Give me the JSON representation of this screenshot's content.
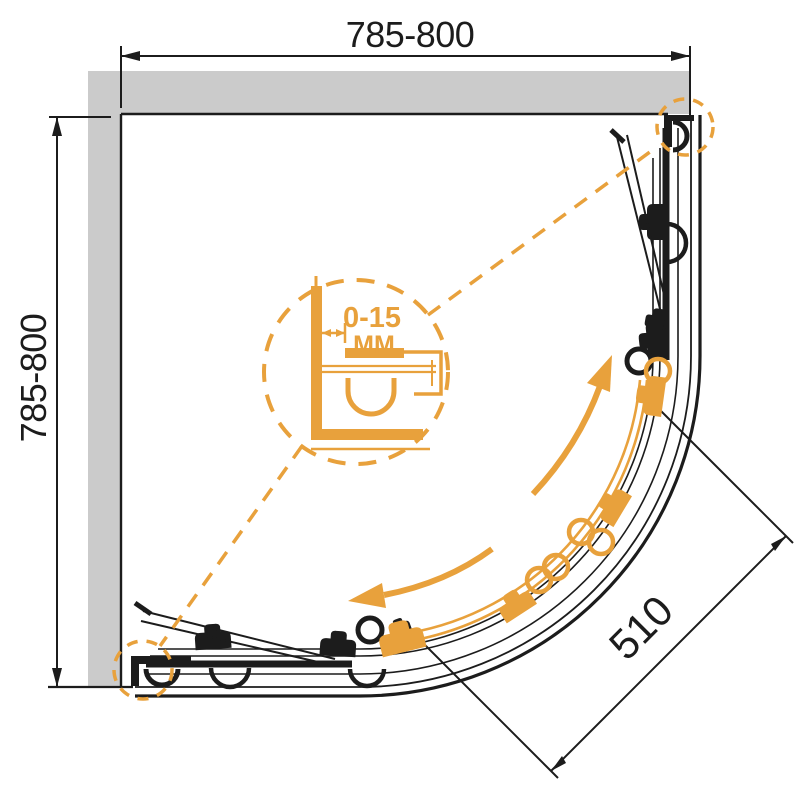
{
  "title": "Quadrant shower enclosure plan drawing",
  "colors": {
    "accent_orange": "#e8a13c",
    "line_black": "#1c1c1c",
    "wall_gray": "#cbcbcb",
    "background": "#ffffff"
  },
  "dimensions": {
    "top_width": "785-800",
    "left_height": "785-800",
    "door_opening": "510"
  },
  "detail_callout": {
    "adjustment_range": "0-15",
    "unit": "MM"
  }
}
